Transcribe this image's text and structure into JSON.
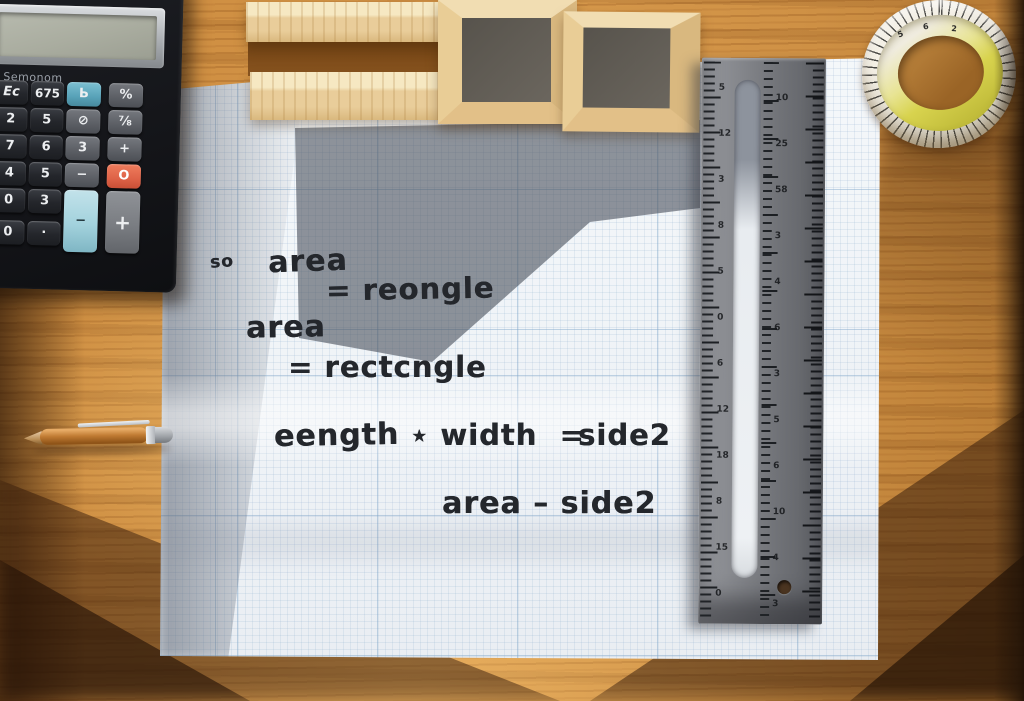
{
  "scene": {
    "description": "Wooden desk, top view: black calculator, light wooden blocks, graph paper with handwritten formulas, steel ruler, coiled tape measure and copper pen"
  },
  "handwriting": {
    "so": "so",
    "area1": "area",
    "eq1": "= reongle",
    "area2": "area",
    "eq2": "= rectcngle",
    "length": "eength",
    "star_width": "⋆ width  =",
    "side2": "side2",
    "final": "area – side2"
  },
  "calculator": {
    "brand": "Semonom",
    "keys": [
      "Ec",
      "675",
      "Ь",
      "%",
      "2",
      "5",
      "⊘",
      "⅞",
      "7",
      "6",
      "3",
      "+",
      "4",
      "5",
      "−",
      "O",
      "0",
      "3",
      "−",
      "+",
      "0",
      "·"
    ]
  },
  "ruler": {
    "left_numbers": [
      "5",
      "12",
      "3",
      "8",
      "5",
      "0",
      "6",
      "12",
      "18",
      "8",
      "15",
      "0"
    ],
    "mid_numbers": [
      "10",
      "25",
      "58",
      "3",
      "4",
      "6",
      "3",
      "5",
      "6",
      "10",
      "4",
      "3"
    ]
  },
  "tape": {
    "numbers": [
      "5",
      "6",
      "2"
    ]
  },
  "colors": {
    "wood": "#cf9145",
    "paper": "#f4f7fa",
    "grid_blue": "#7da4c8",
    "ink": "#24272c",
    "calc_body": "#17191d",
    "key_orange": "#df6247",
    "key_blue": "#64aabf",
    "key_big_blue": "#a6d4de",
    "ruler_gray": "#74767b",
    "tape_yellow": "#d6d14c",
    "pen_copper": "#b5702f"
  }
}
